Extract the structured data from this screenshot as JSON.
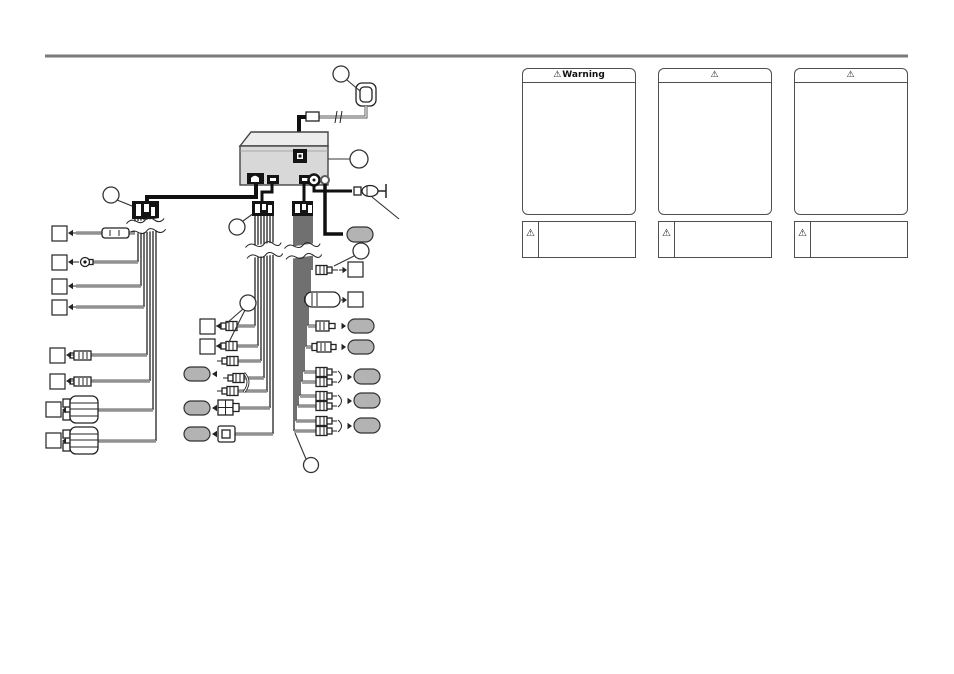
{
  "page": {
    "background": "#ffffff",
    "rule_color": "#7a7a7a"
  },
  "warnings": {
    "symbol": "⚠",
    "panels": [
      {
        "title": "Warning"
      },
      {
        "title": ""
      },
      {
        "title": ""
      }
    ],
    "notes": [
      {
        "symbol": "⚠"
      },
      {
        "symbol": "⚠"
      },
      {
        "symbol": "⚠"
      }
    ]
  },
  "diagram": {
    "colors": {
      "wire": "#232323",
      "unit_front_fill": "#d8d8d8",
      "unit_top_fill": "#ececec",
      "label_oval_fill": "#b3b3b3",
      "connector_block_fill": "#141414"
    },
    "callouts": [
      {
        "label": ""
      },
      {
        "label": ""
      },
      {
        "label": ""
      },
      {
        "label": ""
      },
      {
        "label": ""
      },
      {
        "label": ""
      },
      {
        "label": ""
      }
    ],
    "wire_label_boxes": [
      {
        "text": ""
      },
      {
        "text": ""
      },
      {
        "text": ""
      },
      {
        "text": ""
      },
      {
        "text": ""
      },
      {
        "text": ""
      },
      {
        "text": ""
      },
      {
        "text": ""
      },
      {
        "text": ""
      },
      {
        "text": ""
      },
      {
        "text": ""
      },
      {
        "text": ""
      }
    ],
    "connector_label_ovals": [
      {
        "text": ""
      },
      {
        "text": ""
      },
      {
        "text": ""
      },
      {
        "text": ""
      },
      {
        "text": ""
      },
      {
        "text": ""
      },
      {
        "text": ""
      },
      {
        "text": ""
      },
      {
        "text": ""
      }
    ]
  }
}
